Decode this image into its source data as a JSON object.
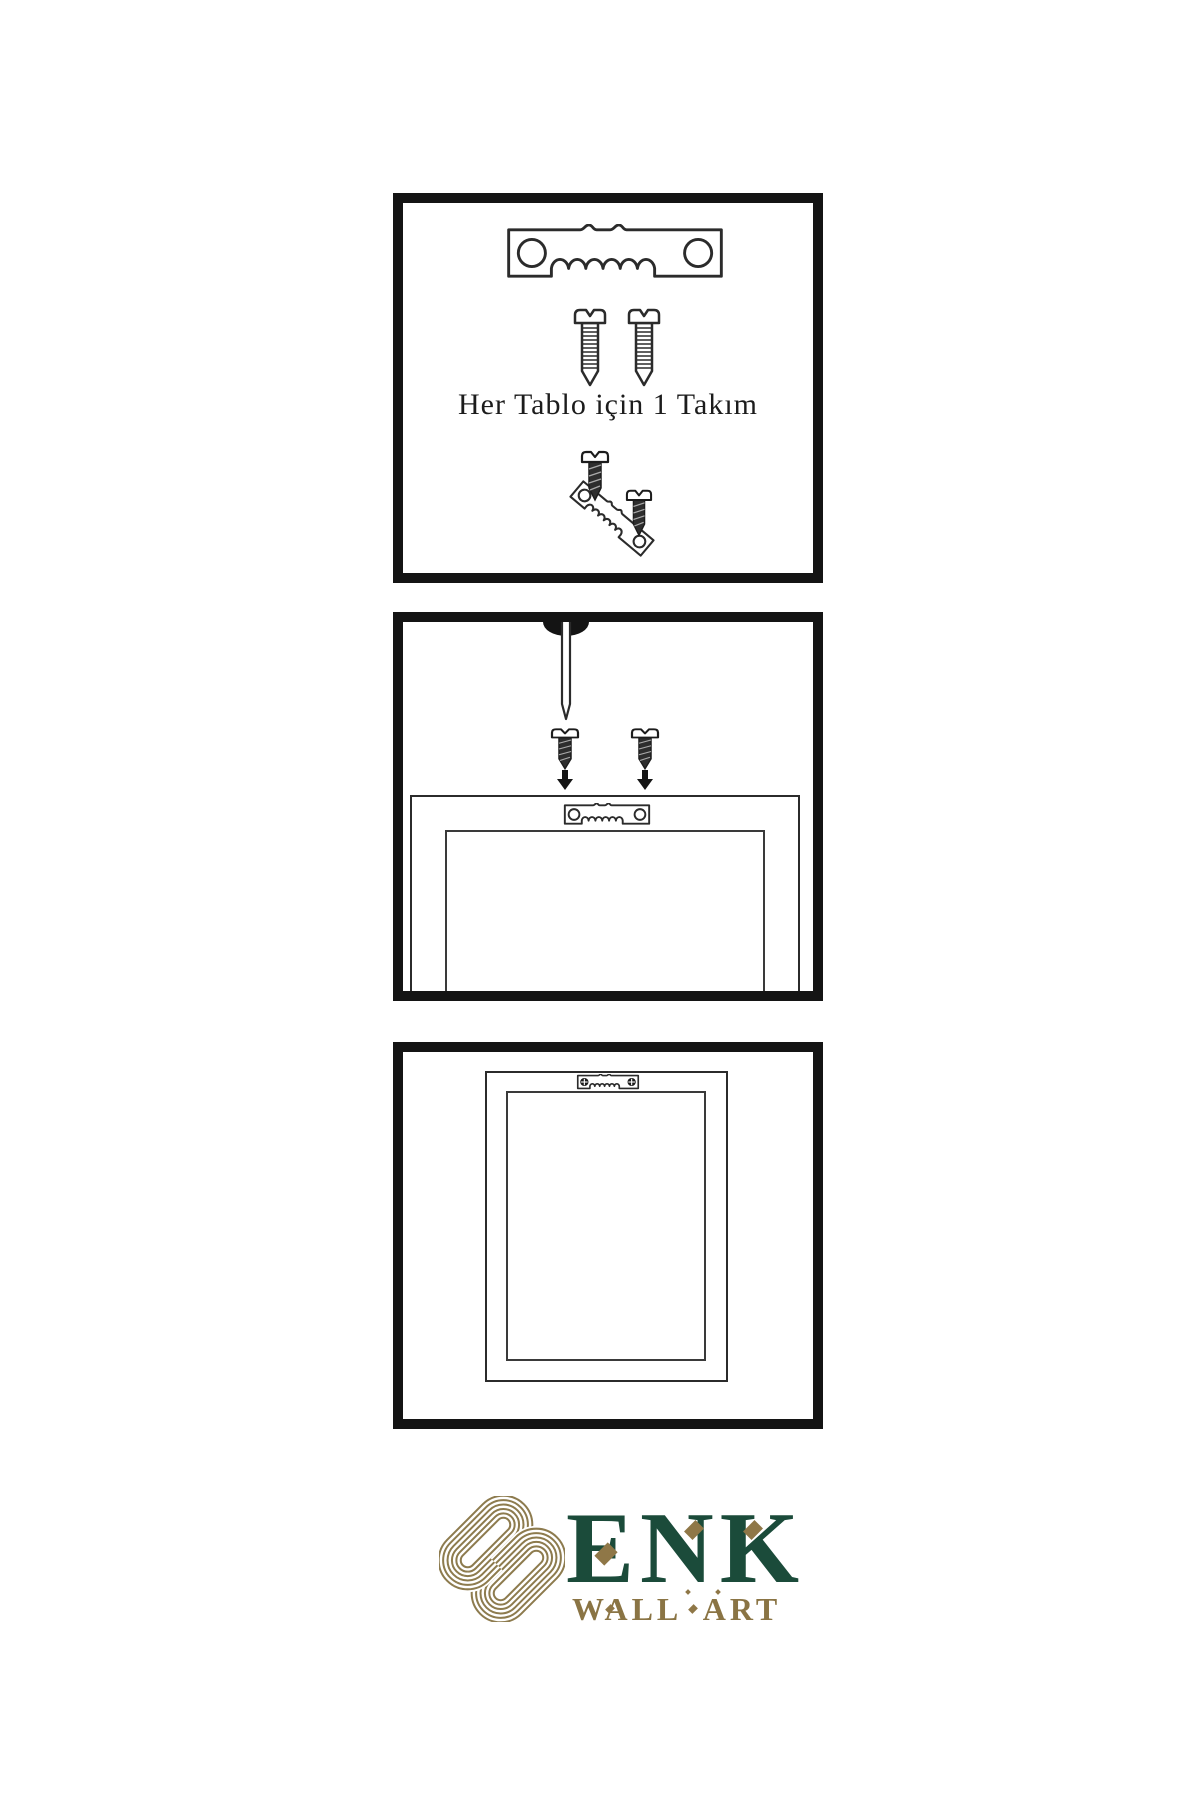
{
  "page": {
    "background": "#ffffff",
    "type": "wall-art-hanging-instructions"
  },
  "instructions": {
    "panel1": {
      "caption": "Her Tablo için 1 Takım",
      "icons": [
        "sawtooth-hanger-icon",
        "screw-icon",
        "screw-icon",
        "screw-icon",
        "angled-sawtooth-hanger-icon",
        "screw-icon"
      ]
    },
    "panel2": {
      "icons": [
        "wall-nail-icon",
        "screw-icon",
        "screw-icon",
        "arrow-down-icon",
        "arrow-down-icon",
        "frame-back",
        "sawtooth-hanger-icon"
      ]
    },
    "panel3": {
      "icons": [
        "frame-back",
        "mounted-sawtooth-hanger-icon"
      ]
    }
  },
  "logo": {
    "brand": "ENK",
    "subtitle": "WALL ART",
    "mark": "interlaced-knot-icon",
    "colors": {
      "brand_green": "#1b4b3a",
      "gold": "#8d7748",
      "knot_gold": "#8d7b4e"
    }
  },
  "colors": {
    "ink": "#2b2b2b",
    "panel_border": "#141414",
    "background": "#ffffff"
  }
}
